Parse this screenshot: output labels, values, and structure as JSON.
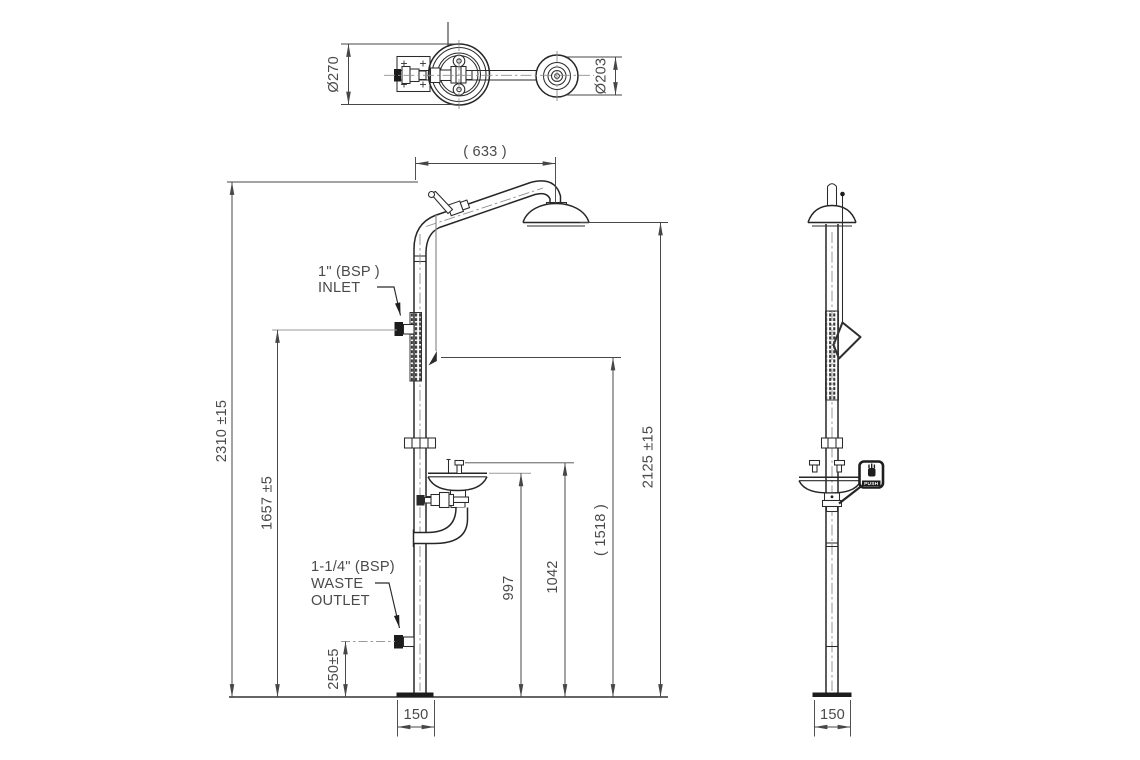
{
  "drawing": {
    "plan": {
      "bowl_dia": "Ø270",
      "head_dia": "Ø203"
    },
    "front": {
      "arm_reach": "( 633 )",
      "overall_height": "2310 ±15",
      "inlet_height": "1657 ±5",
      "handle_height": "( 1518 )",
      "head_clearance": "2125 ±15",
      "bowl_rim_height": "997",
      "spray_height": "1042",
      "waste_height": "250±5",
      "base_width": "150",
      "inlet_label_1": "1\" (BSP )",
      "inlet_label_2": "INLET",
      "waste_label_1": "1-1/4\" (BSP)",
      "waste_label_2": "WASTE",
      "waste_label_3": "OUTLET"
    },
    "side": {
      "base_width": "150",
      "push_plate": "PUSH"
    },
    "colors": {
      "line": "#262626",
      "dimension": "#474747",
      "background": "#ffffff"
    }
  }
}
